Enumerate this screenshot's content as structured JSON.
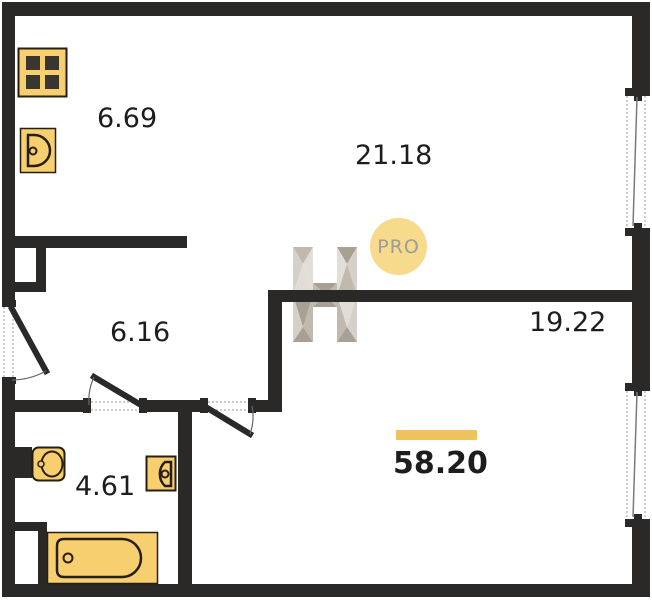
{
  "plan": {
    "rooms": [
      {
        "id": "kitchen",
        "area": "6.69"
      },
      {
        "id": "living",
        "area": "21.18"
      },
      {
        "id": "hallway",
        "area": "6.16"
      },
      {
        "id": "room",
        "area": "19.22"
      },
      {
        "id": "bathroom",
        "area": "4.61"
      }
    ],
    "total_area": "58.20",
    "badge": {
      "text": "PRO"
    },
    "icons": [
      "stove-icon",
      "kitchen-sink-icon",
      "toilet-icon",
      "washbasin-icon",
      "bathtub-icon",
      "window-icon",
      "door-swing-icon",
      "h-logo-watermark-icon"
    ]
  },
  "colors": {
    "wall": "#2b2928",
    "fix": "#f8cf6e",
    "fixs": "#251f12",
    "accent": "#eec35e",
    "badgefill": "#f8da8c",
    "badgetext": "#9c9c9a",
    "label": "#1d1d1d",
    "dotted": "#9a9a9a",
    "arc": "#666666",
    "wma": "#d6d1c8",
    "wmb": "#c0b9ad",
    "wmc": "#e2ded7",
    "wmd": "#a8a093"
  }
}
